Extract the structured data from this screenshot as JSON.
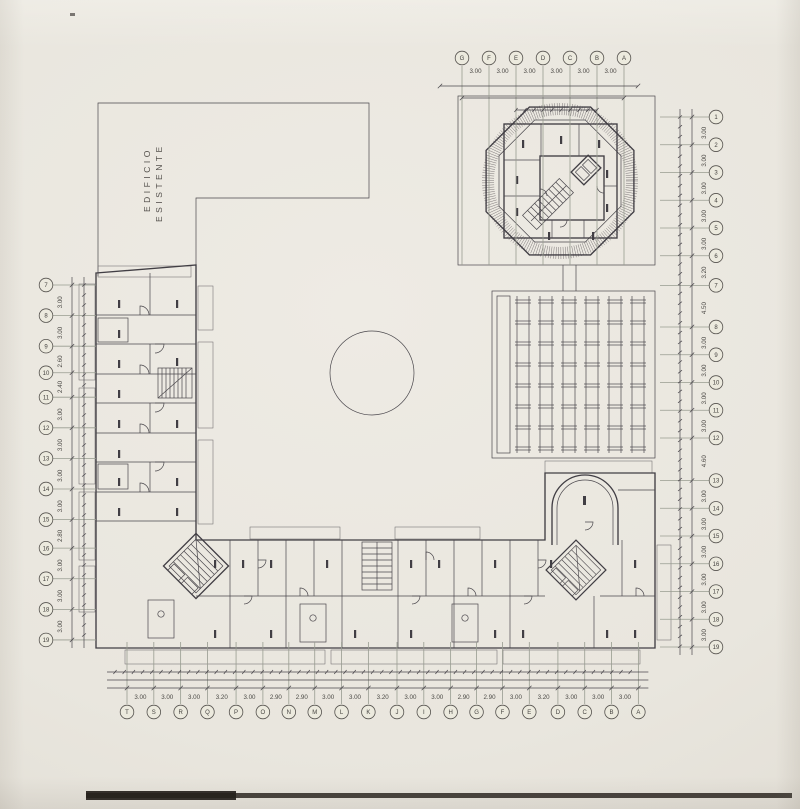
{
  "drawing": {
    "labels": {
      "existing_building_line1": "EDIFICIO",
      "existing_building_line2": "ESISTENTE"
    },
    "colors": {
      "paper": "#e9e6de",
      "ink": "#413e44",
      "grid_line": "#989c90",
      "dim_text": "#4b4945",
      "scan_edge": "#221d19"
    },
    "axes": {
      "top": {
        "letters": [
          "G",
          "F",
          "E",
          "D",
          "C",
          "B",
          "A"
        ],
        "dims": [
          "3.00",
          "3.00",
          "3.00",
          "3.00",
          "3.00",
          "3.00"
        ]
      },
      "bottom": {
        "letters": [
          "T",
          "S",
          "R",
          "Q",
          "P",
          "O",
          "N",
          "M",
          "L",
          "K",
          "J",
          "I",
          "H",
          "G",
          "F",
          "E",
          "D",
          "C",
          "B",
          "A"
        ],
        "dims": [
          "3.00",
          "3.00",
          "3.00",
          "3.20",
          "3.00",
          "2.90",
          "2.90",
          "3.00",
          "3.00",
          "3.20",
          "3.00",
          "3.00",
          "2.90",
          "2.90",
          "3.00",
          "3.20",
          "3.00",
          "3.00",
          "3.00"
        ]
      },
      "left": {
        "letters": [
          "7",
          "8",
          "9",
          "10",
          "11",
          "12",
          "13",
          "14",
          "15",
          "16",
          "17",
          "18",
          "19"
        ],
        "dims": [
          "3.00",
          "3.00",
          "2.60",
          "2.40",
          "3.00",
          "3.00",
          "3.00",
          "3.00",
          "2.80",
          "3.00",
          "3.00",
          "3.00"
        ]
      },
      "right": {
        "letters": [
          "1",
          "2",
          "3",
          "4",
          "5",
          "6",
          "7",
          "8",
          "9",
          "10",
          "11",
          "12",
          "13",
          "14",
          "15",
          "16",
          "17",
          "18",
          "19"
        ],
        "dims": [
          "3.00",
          "3.00",
          "3.00",
          "3.00",
          "3.00",
          "3.20",
          "4.50",
          "3.00",
          "3.00",
          "3.00",
          "3.00",
          "4.60",
          "3.00",
          "3.00",
          "3.00",
          "3.00",
          "3.00",
          "3.00"
        ]
      }
    }
  }
}
